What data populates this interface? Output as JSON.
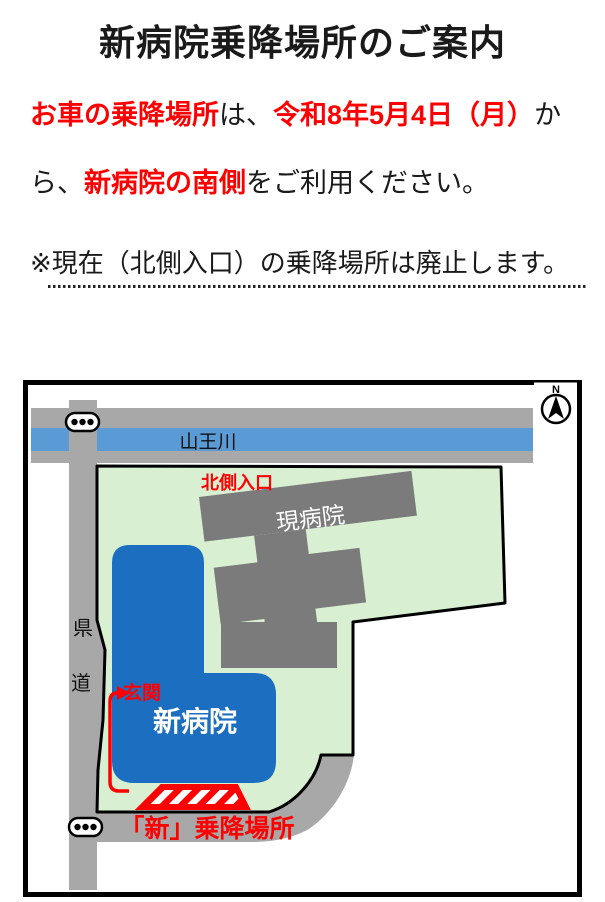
{
  "notice": {
    "title": "新病院乗降場所のご案内",
    "line1_seg1": "お車の乗降場所",
    "line1_seg2": "は、",
    "line1_seg3": "令和8年5月4日（月）",
    "line1_seg4": "か",
    "line2_seg1": "ら、",
    "line2_seg2": "新病院の南側",
    "line2_seg3": "をご利用ください。",
    "note": "※現在（北側入口）の乗降場所は廃止します。"
  },
  "map": {
    "river_label": "山王川",
    "compass_label": "N",
    "north_entrance_label": "北側入口",
    "current_hospital_label": "現病院",
    "new_hospital_label": "新病院",
    "entrance_label": "玄関",
    "new_stop_label": "「新」乗降場所",
    "pref_road_char1": "県",
    "pref_road_char2": "道",
    "colors": {
      "site_green": "#D8EFD2",
      "road_gray": "#A8A8A8",
      "river_blue": "#5B9BD5",
      "building_gray": "#7B7B7B",
      "new_hospital_blue": "#1C6FC0",
      "accent_red": "#FF0000"
    }
  }
}
